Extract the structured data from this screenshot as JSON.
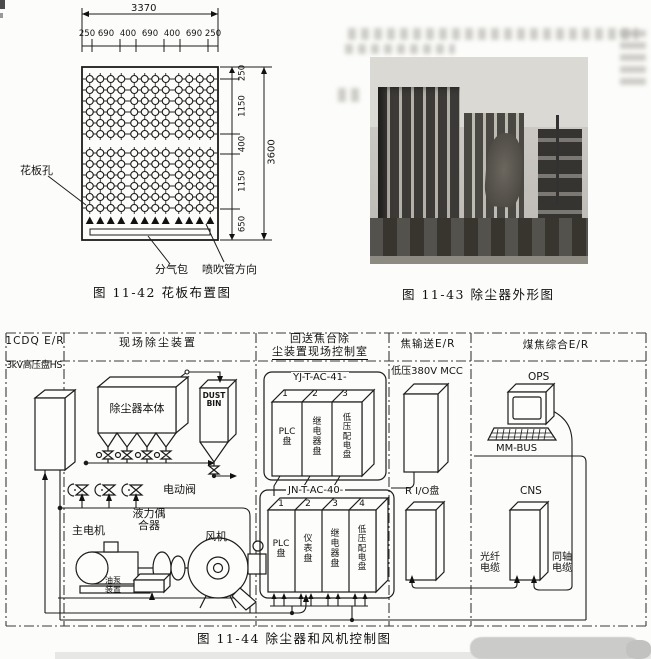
{
  "figure42": {
    "caption": "图 11-42  花板布置图",
    "label_hole": "花板孔",
    "label_air_header": "分气包",
    "label_blow_dir": "喷吹管方向",
    "dim_total_width": "3370",
    "dim_total_height": "3600",
    "dim_top_segments": [
      "250",
      "690",
      "400",
      "690",
      "400",
      "690",
      "250"
    ],
    "dim_right_segments": [
      "250",
      "1150",
      "400",
      "1150",
      "650"
    ],
    "grid": {
      "groups": 3,
      "cols": 4,
      "blocks": 2,
      "rows": 6,
      "triangles_per_group": 4
    }
  },
  "figure43": {
    "caption": "图 11-43  除尘器外形图"
  },
  "figure44": {
    "caption": "图 11-44  除尘器和风机控制图",
    "sections": {
      "cdq": "1CDQ E/R",
      "site": "现场除尘装置",
      "ctrl_room_line1": "回送焦台除",
      "ctrl_room_line2": "尘装置现场控制室",
      "coke_er": "焦输送E/R",
      "coal_er": "煤焦综合E/R"
    },
    "labels": {
      "hv_panel": "3kV高压盘HS",
      "collector_body": "除尘器本体",
      "dust_bin": "DUST\nBIN",
      "motor_valve": "电动阀",
      "main_motor": "主电机",
      "fluid_coupling": "液力偶\n合器",
      "fan": "风机",
      "oil_pump": "油泵\n装置",
      "mcc": "低压380V MCC",
      "remote_io": "R I/O盘",
      "ops": "OPS",
      "mm_bus": "MM-BUS",
      "cns": "CNS",
      "fiber_cable": "光纤\n电缆",
      "coax_cable": "同轴\n电缆"
    },
    "cabinet1": {
      "title": "YJ-T-AC-41-",
      "panels": [
        {
          "num": "1",
          "label": "PLC\n盘"
        },
        {
          "num": "2",
          "label": "继\n电\n器\n盘"
        },
        {
          "num": "3",
          "label": "低\n压\n配\n电\n盘"
        }
      ]
    },
    "cabinet2": {
      "title": "JN-T-AC-40-",
      "panels": [
        {
          "num": "1",
          "label": "PLC\n盘"
        },
        {
          "num": "2",
          "label": "仪\n表\n盘"
        },
        {
          "num": "3",
          "label": "继\n电\n器\n盘"
        },
        {
          "num": "4",
          "label": "低\n压\n配\n电\n盘"
        }
      ]
    }
  }
}
